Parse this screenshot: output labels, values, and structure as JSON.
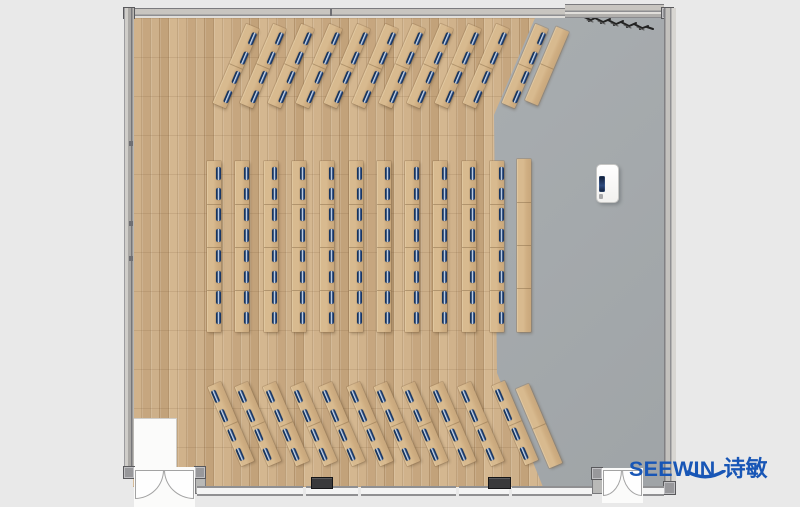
{
  "page": {
    "background": "#e9e9e9"
  },
  "logo": {
    "text_en": "SEEWIN",
    "text_zh": "诗敏",
    "color": "#1856b6"
  },
  "palette": {
    "wood_floor": "#c9ab84",
    "gray_floor": "#a8adb0",
    "desk_wood": "#d5b78c",
    "chair_navy": "#16345f",
    "wall_gray": "#c3c1bd",
    "wall_line": "#78787b",
    "pillar_dark": "#39393b",
    "door_white": "#fdfdfd",
    "podium_screen": "#1d2b45",
    "scribble": "#222222"
  },
  "room": {
    "floor_left": "wood-plank",
    "floor_right": "gray",
    "doors": [
      "double-door-bottom-left",
      "double-door-bottom-right"
    ],
    "pillars_on_bottom_wall": 2
  },
  "floorplan": {
    "chair": {
      "w": 5,
      "h": 12.5
    },
    "desk_sections": [
      {
        "name": "top-angled-rows",
        "rotation_deg": 23,
        "strip_w": 14,
        "strip_h": 86,
        "seats_per_strip": 4,
        "seat_side": "right",
        "seat_start": 5,
        "seat_spacing": 21,
        "seams": [
          43
        ],
        "strips": [
          [
            235.5,
            65.5
          ],
          [
            263.3,
            65.5
          ],
          [
            291.1,
            65.5
          ],
          [
            318.9,
            65.5
          ],
          [
            346.7,
            65.5
          ],
          [
            374.5,
            65.5
          ],
          [
            402.3,
            65.5
          ],
          [
            430.1,
            65.5
          ],
          [
            457.9,
            65.5
          ],
          [
            485.7,
            65.5
          ],
          [
            525,
            65.5
          ]
        ]
      },
      {
        "name": "middle-straight-rows",
        "rotation_deg": 0,
        "strip_w": 14,
        "strip_h": 171,
        "seats_per_strip": 8,
        "seat_side": "right",
        "seat_start": 6,
        "seat_spacing": 20.7,
        "seams": [
          43,
          86,
          129
        ],
        "strips": [
          [
            214,
            246.5
          ],
          [
            242.3,
            246.5
          ],
          [
            270.6,
            246.5
          ],
          [
            298.9,
            246.5
          ],
          [
            327.2,
            246.5
          ],
          [
            355.5,
            246.5
          ],
          [
            383.8,
            246.5
          ],
          [
            412.1,
            246.5
          ],
          [
            440.4,
            246.5
          ],
          [
            468.7,
            246.5
          ],
          [
            497,
            246.5
          ]
        ]
      },
      {
        "name": "bottom-angled-rows",
        "rotation_deg": -23,
        "strip_w": 14,
        "strip_h": 86,
        "seats_per_strip": 4,
        "seat_side": "left",
        "seat_start": 5,
        "seat_spacing": 21,
        "seams": [
          43
        ],
        "strips": [
          [
            230.5,
            423.5
          ],
          [
            258.3,
            423.5
          ],
          [
            286.1,
            423.5
          ],
          [
            313.9,
            423.5
          ],
          [
            341.7,
            423.5
          ],
          [
            369.5,
            423.5
          ],
          [
            397.3,
            423.5
          ],
          [
            425.1,
            423.5
          ],
          [
            452.9,
            423.5
          ],
          [
            480.7,
            423.5
          ],
          [
            515,
            423
          ]
        ]
      }
    ],
    "side_counters": [
      {
        "name": "counter-top-right",
        "cx": 546.5,
        "cy": 65.5,
        "w": 14,
        "h": 80,
        "rotation_deg": 23,
        "seams": [
          40
        ]
      },
      {
        "name": "counter-middle-right",
        "cx": 524,
        "cy": 245.5,
        "w": 14,
        "h": 173,
        "rotation_deg": 0,
        "seams": [
          43,
          86,
          129
        ]
      },
      {
        "name": "counter-bottom-right",
        "cx": 539,
        "cy": 426,
        "w": 14,
        "h": 86,
        "rotation_deg": -23,
        "seams": [
          43
        ]
      }
    ],
    "podium": {
      "cx": 607.5,
      "cy": 183.5
    }
  }
}
